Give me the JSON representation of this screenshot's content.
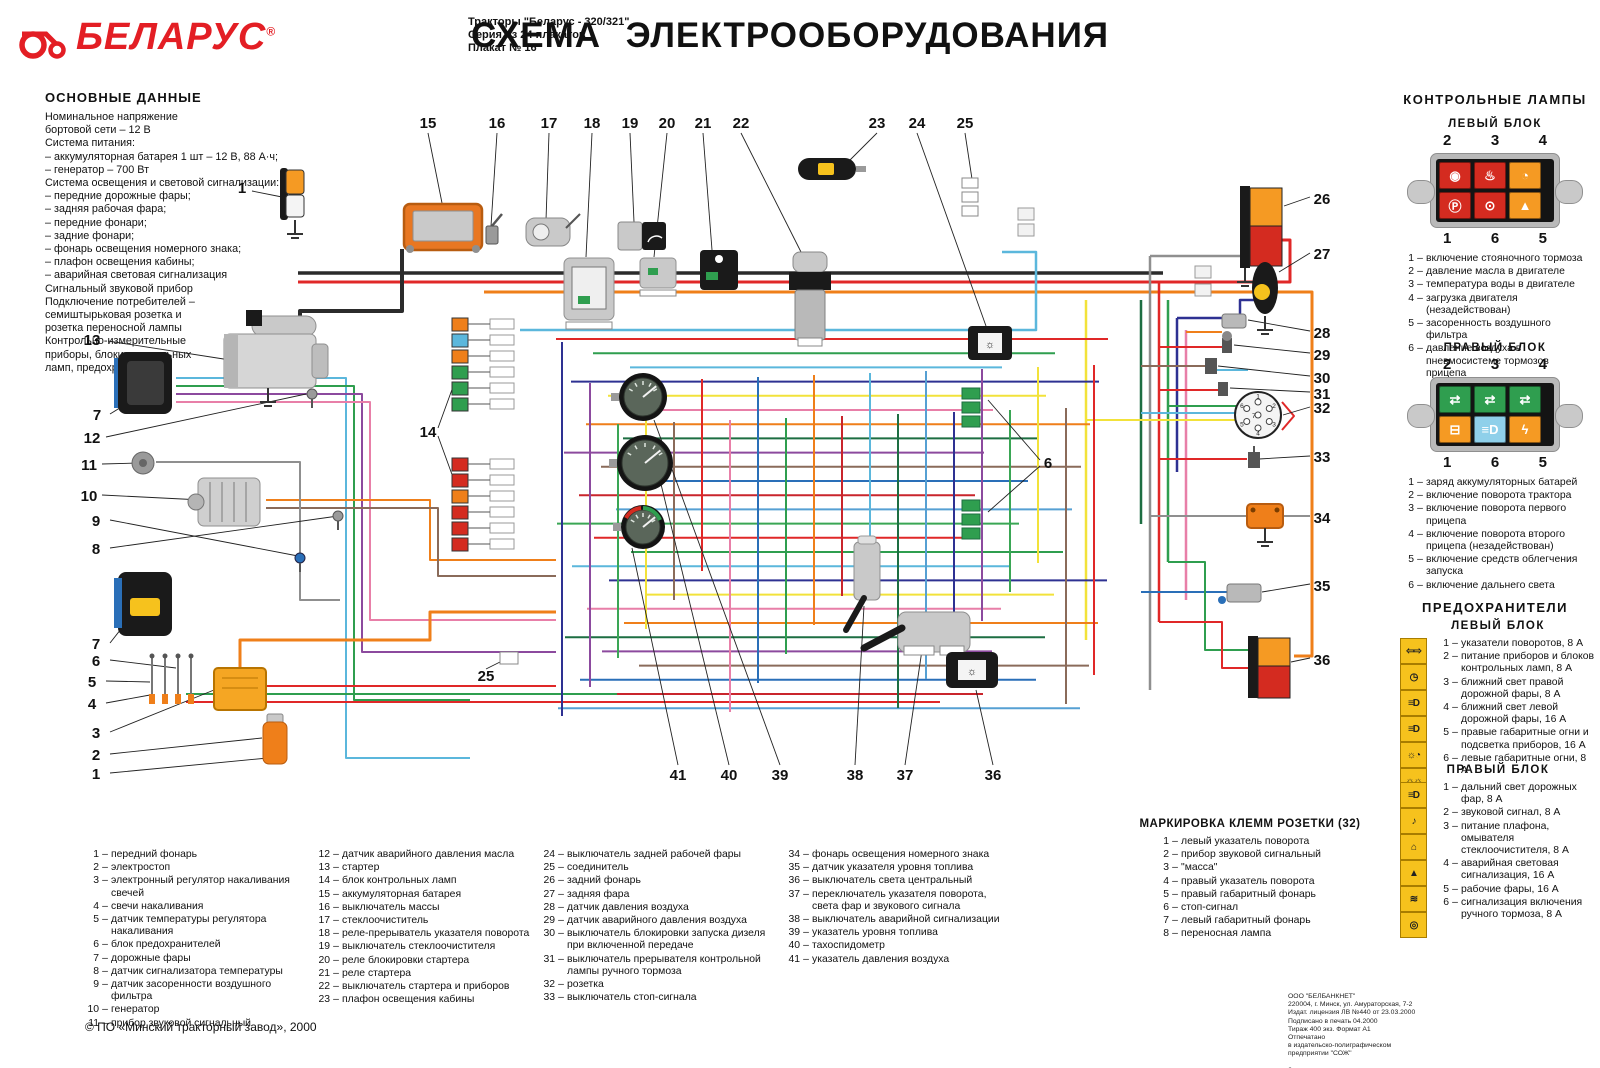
{
  "header": {
    "logo_text": "БЕЛАРУС",
    "logo_reg": "®",
    "subtitle_lines": [
      "Тракторы \"Беларус - 320/321\"",
      "Серия из 24 плакатов",
      "Плакат № 16"
    ],
    "title": "СХЕМА ЭЛЕКТРООБОРУДОВАНИЯ",
    "brand_color": "#e31e24"
  },
  "main_data": {
    "title": "ОСНОВНЫЕ ДАННЫЕ",
    "lines": [
      "Номинальное напряжение",
      "бортовой сети  – 12 В",
      "Система питания:",
      "– аккумуляторная батарея 1 шт – 12 В, 88 А·ч;",
      "– генератор – 700 Вт",
      "Система освещения и  световой сигнализации:",
      "– передние  дорожные  фары;",
      "– задняя рабочая фара;",
      "– передние фонари;",
      "– задние фонари;",
      "– фонарь освещения номерного знака;",
      "– плафон освещения кабины;",
      "– аварийная световая сигнализация",
      "Сигнальный звуковой прибор",
      "Подключение потребителей –",
      "семиштырьковая розетка и",
      "розетка переносной лампы",
      "Контрольно-измерительные",
      "приборы, блоки  контрольных",
      "ламп, предохранители"
    ]
  },
  "control_lamps": {
    "title": "КОНТРОЛЬНЫЕ ЛАМПЫ",
    "left_block": {
      "title": "ЛЕВЫЙ БЛОК",
      "numbers_top": [
        "2",
        "3",
        "4"
      ],
      "numbers_bottom": [
        "1",
        "6",
        "5"
      ],
      "cells_top": [
        {
          "name": "oil-pressure-lamp",
          "color": "#d42b20",
          "glyph": "◉"
        },
        {
          "name": "water-temp-lamp",
          "color": "#d42b20",
          "glyph": "♨"
        },
        {
          "name": "engine-load-lamp",
          "color": "#f59a23",
          "glyph": "◔"
        }
      ],
      "cells_bottom": [
        {
          "name": "parking-brake-lamp",
          "color": "#d42b20",
          "glyph": "Ⓟ"
        },
        {
          "name": "trailer-air-pressure-lamp",
          "color": "#d42b20",
          "glyph": "⊙"
        },
        {
          "name": "air-filter-lamp",
          "color": "#f59a23",
          "glyph": "▲"
        }
      ],
      "items": [
        {
          "n": "1",
          "t": "включение стояночного тормоза"
        },
        {
          "n": "2",
          "t": "давление масла в двигателе"
        },
        {
          "n": "3",
          "t": "температура воды в двигателе"
        },
        {
          "n": "4",
          "t": "загрузка двигателя (незадействован)"
        },
        {
          "n": "5",
          "t": "засоренность воздушного фильтра"
        },
        {
          "n": "6",
          "t": "давление воздуха в пневмосистеме тормозов прицепа"
        }
      ]
    },
    "right_block": {
      "title": "ПРАВЫЙ БЛОК",
      "numbers_top": [
        "2",
        "3",
        "4"
      ],
      "numbers_bottom": [
        "1",
        "6",
        "5"
      ],
      "cells_top": [
        {
          "name": "tractor-turn-lamp",
          "color": "#2f9e4f",
          "glyph": "⇄"
        },
        {
          "name": "trailer1-turn-lamp",
          "color": "#2f9e4f",
          "glyph": "⇄"
        },
        {
          "name": "trailer2-turn-lamp",
          "color": "#2f9e4f",
          "glyph": "⇄"
        }
      ],
      "cells_bottom": [
        {
          "name": "battery-charge-lamp",
          "color": "#f59a23",
          "glyph": "⊟"
        },
        {
          "name": "high-beam-lamp",
          "color": "#8fd0ea",
          "glyph": "≡D"
        },
        {
          "name": "glow-plug-lamp",
          "color": "#f59a23",
          "glyph": "ϟ"
        }
      ],
      "items": [
        {
          "n": "1",
          "t": "заряд аккумуляторных батарей"
        },
        {
          "n": "2",
          "t": "включение поворота трактора"
        },
        {
          "n": "3",
          "t": "включение поворота первого прицепа"
        },
        {
          "n": "4",
          "t": "включение поворота второго прицепа (незадействован)"
        },
        {
          "n": "5",
          "t": "включение средств облегчения запуска"
        },
        {
          "n": "6",
          "t": "включение дальнего света"
        }
      ]
    }
  },
  "fuses": {
    "title": "ПРЕДОХРАНИТЕЛИ",
    "left_block": {
      "title": "ЛЕВЫЙ БЛОК",
      "items": [
        {
          "n": "1",
          "t": "указатели  поворотов, 8 А",
          "icon": "turn-indicators-icon",
          "glyph": "⇦⇨"
        },
        {
          "n": "2",
          "t": "питание приборов и  блоков контрольных ламп, 8 А",
          "icon": "instruments-icon",
          "glyph": "◷"
        },
        {
          "n": "3",
          "t": "ближний свет правой дорожной фары, 8 А",
          "icon": "low-beam-right-icon",
          "glyph": "≡D"
        },
        {
          "n": "4",
          "t": "ближний свет левой дорожной фары, 16 А",
          "icon": "low-beam-left-icon",
          "glyph": "≡D"
        },
        {
          "n": "5",
          "t": "правые габаритные огни  и подсветка приборов, 16 А",
          "icon": "marker-lights-right-icon",
          "glyph": "☼◔"
        },
        {
          "n": "6",
          "t": "левые габаритные огни, 8 А",
          "icon": "marker-lights-left-icon",
          "glyph": "☼☼"
        }
      ]
    },
    "right_block": {
      "title": "ПРАВЫЙ БЛОК",
      "items": [
        {
          "n": "1",
          "t": "дальний свет дорожных фар, 8 А",
          "icon": "high-beam-icon",
          "glyph": "≡D"
        },
        {
          "n": "2",
          "t": "звуковой сигнал, 8 А",
          "icon": "horn-icon",
          "glyph": "♪"
        },
        {
          "n": "3",
          "t": "питание плафона, омывателя стеклоочистителя, 8 А",
          "icon": "dome-light-icon",
          "glyph": "⌂"
        },
        {
          "n": "4",
          "t": "аварийная световая сигнализация, 16 А",
          "icon": "hazard-icon",
          "glyph": "▲"
        },
        {
          "n": "5",
          "t": "рабочие фары, 16 А",
          "icon": "work-lights-icon",
          "glyph": "≋"
        },
        {
          "n": "6",
          "t": "сигнализация включения ручного тормоза, 8 А",
          "icon": "park-brake-icon",
          "glyph": "◎"
        }
      ]
    }
  },
  "legend": {
    "columns": [
      [
        {
          "n": "1",
          "t": "передний фонарь"
        },
        {
          "n": "2",
          "t": "электростоп"
        },
        {
          "n": "3",
          "t": "электронный регулятор накаливания свечей"
        },
        {
          "n": "4",
          "t": "свечи  накаливания"
        },
        {
          "n": "5",
          "t": "датчик температуры регулятора накаливания"
        },
        {
          "n": "6",
          "t": "блок предохранителей"
        },
        {
          "n": "7",
          "t": "дорожные фары"
        },
        {
          "n": "8",
          "t": "датчик сигнализатора температуры"
        },
        {
          "n": "9",
          "t": "датчик засоренности  воздушного фильтра"
        },
        {
          "n": "10",
          "t": "генератор"
        },
        {
          "n": "11",
          "t": "прибор звуковой сигнальный"
        }
      ],
      [
        {
          "n": "12",
          "t": "датчик аварийного давления масла"
        },
        {
          "n": "13",
          "t": "стартер"
        },
        {
          "n": "14",
          "t": "блок контрольных ламп"
        },
        {
          "n": "15",
          "t": "аккумуляторная батарея"
        },
        {
          "n": "16",
          "t": "выключатель массы"
        },
        {
          "n": "17",
          "t": "стеклоочиститель"
        },
        {
          "n": "18",
          "t": "реле-прерыватель указателя поворота"
        },
        {
          "n": "19",
          "t": "выключатель стеклоочистителя"
        },
        {
          "n": "20",
          "t": "реле блокировки  стартера"
        },
        {
          "n": "21",
          "t": "реле стартера"
        },
        {
          "n": "22",
          "t": "выключатель стартера и  приборов"
        },
        {
          "n": "23",
          "t": "плафон освещения кабины"
        }
      ],
      [
        {
          "n": "24",
          "t": "выключатель задней рабочей фары"
        },
        {
          "n": "25",
          "t": "соединитель"
        },
        {
          "n": "26",
          "t": "задний фонарь"
        },
        {
          "n": "27",
          "t": "задняя фара"
        },
        {
          "n": "28",
          "t": "датчик давления воздуха"
        },
        {
          "n": "29",
          "t": "датчик аварийного давления воздуха"
        },
        {
          "n": "30",
          "t": "выключатель блокировки  запуска дизеля при  включенной передаче"
        },
        {
          "n": "31",
          "t": "выключатель прерывателя контрольной лампы ручного тормоза"
        },
        {
          "n": "32",
          "t": "розетка"
        },
        {
          "n": "33",
          "t": "выключатель стоп-сигнала"
        }
      ],
      [
        {
          "n": "34",
          "t": "фонарь освещения номерного знака"
        },
        {
          "n": "35",
          "t": "датчик указателя уровня топлива"
        },
        {
          "n": "36",
          "t": "выключатель света центральный"
        },
        {
          "n": "37",
          "t": "переключатель указателя поворота, света фар и  звукового сигнала"
        },
        {
          "n": "38",
          "t": "выключатель аварийной сигнализации"
        },
        {
          "n": "39",
          "t": "указатель уровня топлива"
        },
        {
          "n": "40",
          "t": "тахоспидометр"
        },
        {
          "n": "41",
          "t": "указатель давления воздуха"
        }
      ]
    ]
  },
  "socket_marking": {
    "title": "МАРКИРОВКА КЛЕММ РОЗЕТКИ (32)",
    "items": [
      {
        "n": "1",
        "t": "левый указатель поворота"
      },
      {
        "n": "2",
        "t": "прибор звуковой сигнальный"
      },
      {
        "n": "3",
        "t": "\"масса\""
      },
      {
        "n": "4",
        "t": "правый указатель поворота"
      },
      {
        "n": "5",
        "t": "правый габаритный фонарь"
      },
      {
        "n": "6",
        "t": "стоп-сигнал"
      },
      {
        "n": "7",
        "t": "левый габаритный фонарь"
      },
      {
        "n": "8",
        "t": "переносная лампа"
      }
    ]
  },
  "publisher": {
    "lines": [
      "ООО \"БЕЛБАНКНЕТ\"",
      "220004, г. Минск, ул. Амураторская, 7-2",
      "Издат. лицензия ЛВ №440 от 23.03.2000",
      "Подписано в печать    04.2000",
      "Тираж 400 экз. Формат А1",
      "Отпечатано",
      "в издательско-полиграфическом",
      "предприятии \"СОЖ\"",
      "",
      "Заказ"
    ]
  },
  "footer": "© ПО «Минский тракторный завод», 2000",
  "diagram": {
    "socket_pins": [
      "1",
      "2",
      "3",
      "4",
      "5",
      "6",
      "7"
    ],
    "palette": {
      "red": "#e02828",
      "orange": "#ef7f1a",
      "yellow": "#f2e23a",
      "green": "#2f9e4f",
      "dark_green": "#1d6e42",
      "cyan": "#5bb7dc",
      "blue": "#2a6fb8",
      "navy": "#2e3192",
      "purple": "#8c4a9e",
      "pink": "#e87fa8",
      "brown": "#8a6b5a",
      "gray": "#8f8f8f",
      "black": "#2b2b2b"
    },
    "callouts": [
      {
        "n": "15",
        "x": 428,
        "y": 123
      },
      {
        "n": "16",
        "x": 497,
        "y": 123
      },
      {
        "n": "17",
        "x": 549,
        "y": 123
      },
      {
        "n": "18",
        "x": 592,
        "y": 123
      },
      {
        "n": "19",
        "x": 630,
        "y": 123
      },
      {
        "n": "20",
        "x": 667,
        "y": 123
      },
      {
        "n": "21",
        "x": 703,
        "y": 123
      },
      {
        "n": "22",
        "x": 741,
        "y": 123
      },
      {
        "n": "23",
        "x": 877,
        "y": 123
      },
      {
        "n": "24",
        "x": 917,
        "y": 123
      },
      {
        "n": "25",
        "x": 965,
        "y": 123
      },
      {
        "n": "1",
        "x": 242,
        "y": 188
      },
      {
        "n": "13",
        "x": 92,
        "y": 340
      },
      {
        "n": "7",
        "x": 97,
        "y": 415
      },
      {
        "n": "12",
        "x": 92,
        "y": 438
      },
      {
        "n": "11",
        "x": 89,
        "y": 465
      },
      {
        "n": "10",
        "x": 89,
        "y": 496
      },
      {
        "n": "9",
        "x": 96,
        "y": 521
      },
      {
        "n": "8",
        "x": 96,
        "y": 549
      },
      {
        "n": "7",
        "x": 96,
        "y": 644
      },
      {
        "n": "6",
        "x": 96,
        "y": 661
      },
      {
        "n": "5",
        "x": 92,
        "y": 682
      },
      {
        "n": "4",
        "x": 92,
        "y": 704
      },
      {
        "n": "3",
        "x": 96,
        "y": 733
      },
      {
        "n": "2",
        "x": 96,
        "y": 755
      },
      {
        "n": "1",
        "x": 96,
        "y": 774
      },
      {
        "n": "26",
        "x": 1322,
        "y": 199
      },
      {
        "n": "27",
        "x": 1322,
        "y": 254
      },
      {
        "n": "28",
        "x": 1322,
        "y": 333
      },
      {
        "n": "29",
        "x": 1322,
        "y": 355
      },
      {
        "n": "30",
        "x": 1322,
        "y": 378
      },
      {
        "n": "31",
        "x": 1322,
        "y": 394
      },
      {
        "n": "32",
        "x": 1322,
        "y": 408
      },
      {
        "n": "33",
        "x": 1322,
        "y": 457
      },
      {
        "n": "34",
        "x": 1322,
        "y": 518
      },
      {
        "n": "35",
        "x": 1322,
        "y": 586
      },
      {
        "n": "36",
        "x": 1322,
        "y": 660
      },
      {
        "n": "6",
        "x": 1048,
        "y": 463
      },
      {
        "n": "41",
        "x": 678,
        "y": 775
      },
      {
        "n": "40",
        "x": 729,
        "y": 775
      },
      {
        "n": "39",
        "x": 780,
        "y": 775
      },
      {
        "n": "38",
        "x": 855,
        "y": 775
      },
      {
        "n": "37",
        "x": 905,
        "y": 775
      },
      {
        "n": "36",
        "x": 993,
        "y": 775
      },
      {
        "n": "25",
        "x": 486,
        "y": 676
      },
      {
        "n": "14",
        "x": 428,
        "y": 432
      }
    ]
  }
}
